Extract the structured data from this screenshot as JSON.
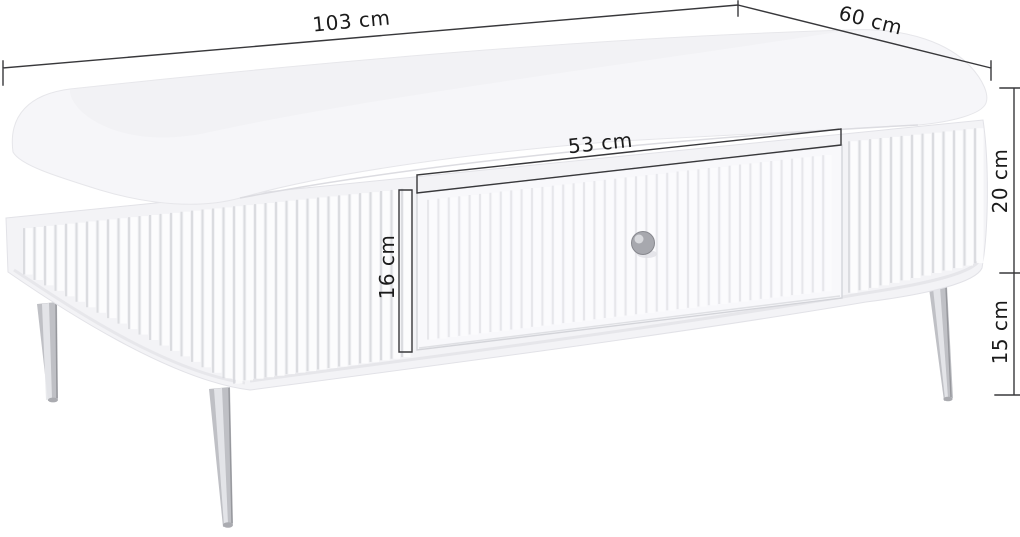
{
  "diagram": {
    "title": "Coffee table dimension diagram",
    "product": "fluted coffee table with central drawer and tapered metal legs",
    "background": "#ffffff",
    "dimensions": {
      "width": {
        "label": "103 cm",
        "value": 103,
        "unit": "cm"
      },
      "depth": {
        "label": "60 cm",
        "value": 60,
        "unit": "cm"
      },
      "drawer_width": {
        "label": "53 cm",
        "value": 53,
        "unit": "cm"
      },
      "drawer_height": {
        "label": "16 cm",
        "value": 16,
        "unit": "cm"
      },
      "body_height": {
        "label": "20 cm",
        "value": 20,
        "unit": "cm"
      },
      "leg_height": {
        "label": "15 cm",
        "value": 15,
        "unit": "cm"
      }
    },
    "colors": {
      "table_body": "#f3f3f6",
      "table_top": "#f6f6f9",
      "drawer_front": "#f8f8fb",
      "flute_shadow": "#d7d8dd",
      "dimension_line": "#38383b",
      "label_text": "#1b1b1b",
      "knob": "#a7a8ae",
      "legs": "#bfc0c5"
    }
  }
}
